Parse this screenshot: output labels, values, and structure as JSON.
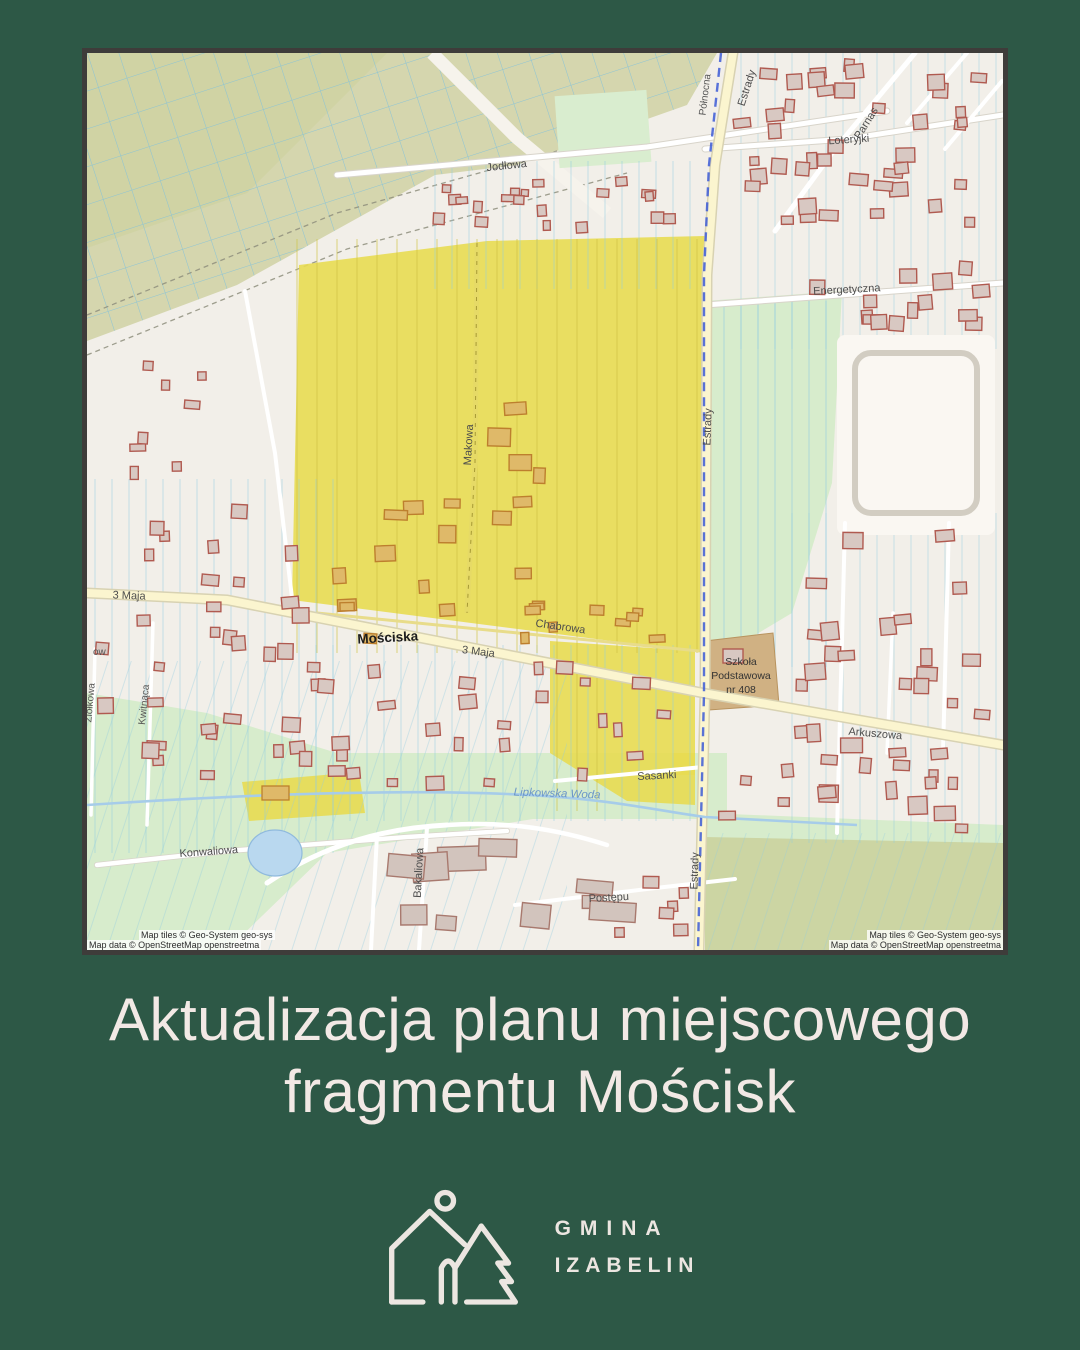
{
  "poster": {
    "bg_color": "#2d5846"
  },
  "headline": {
    "line1": "Aktualizacja planu miejscowego",
    "line2": "fragmentu Mościsk",
    "color": "#f2e9e5"
  },
  "logo": {
    "org_line1": "GMINA",
    "org_line2": "IZABELIN",
    "color": "#ece6e1"
  },
  "map": {
    "highlight_color": "#e8dc52",
    "attribution_tiles": "Map tiles © Geo-System geo-sys",
    "attribution_data": "Map data © OpenStreetMap openstreetma",
    "labels": {
      "jodlowa": "Jodłowa",
      "loteryjki": "Loteryjki",
      "parnas": "Parnas",
      "energetyczna": "Energetyczna",
      "estrady": "Estrady",
      "polnocna": "Północna",
      "moscsiska": "Mościska",
      "trzeciego_maja": "3 Maja",
      "chabrowa": "Chabrowa",
      "makowa": "Makowa",
      "szkola_1": "Szkoła",
      "szkola_2": "Podstawowa",
      "szkola_3": "nr 408",
      "arkuszowa": "Arkuszowa",
      "sasanki": "Sasanki",
      "konwaliowa": "Konwaliowa",
      "kwitnaca": "Kwitnąca",
      "ziolkowa": "Ziółkowa",
      "edge_fragment": "ow",
      "bakaliowa": "Bakaliowa",
      "postepu": "Postępu",
      "lipkowska_woda": "Lipkowska Woda"
    }
  }
}
